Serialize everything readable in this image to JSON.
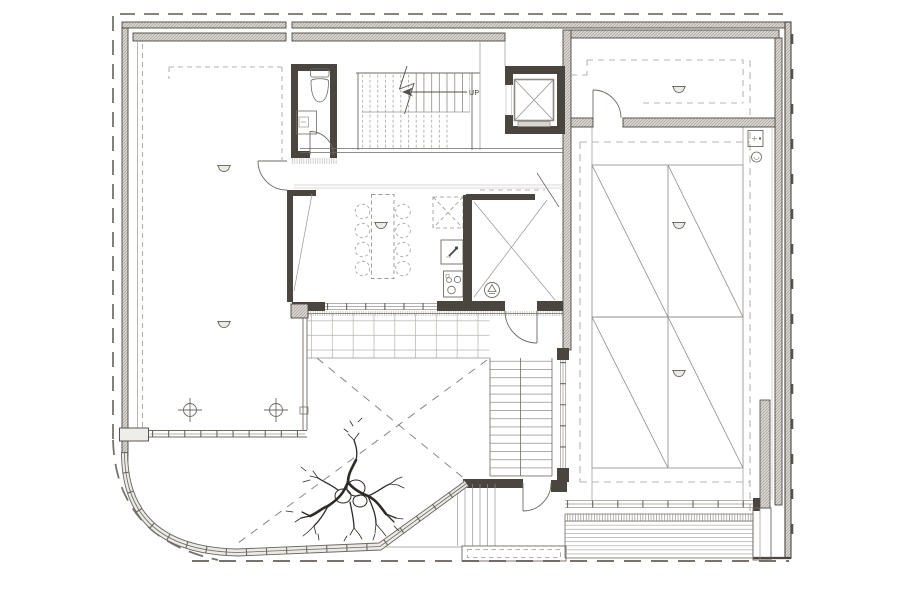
{
  "page": {
    "kind": "architectural-floor-plan",
    "background": "#ffffff"
  },
  "labels": {
    "stair_direction": "UP"
  },
  "palette": {
    "paper": "#ffffff",
    "line": "#6e6862",
    "thin_line": "#9a958f",
    "wall_poche": "#4b4540",
    "wall_hatch": "#d9d6d2",
    "dashed_ceiling": "#a39e98",
    "boundary_dash": "#77726c"
  },
  "features": [
    "site-boundary-dashed",
    "perimeter-hatched-walls",
    "left-hall",
    "wc",
    "staircase-up",
    "elevator",
    "dining-table-eight-chairs",
    "kitchenette",
    "pantry",
    "double-height-hall-glazed-panels",
    "upper-right-room",
    "terrace-paving",
    "terrace-cross-dashed",
    "outdoor-stair",
    "tree",
    "planter",
    "slatted-deck",
    "curved-curtain-wall",
    "ceiling-light-symbols",
    "column-target-symbols"
  ]
}
